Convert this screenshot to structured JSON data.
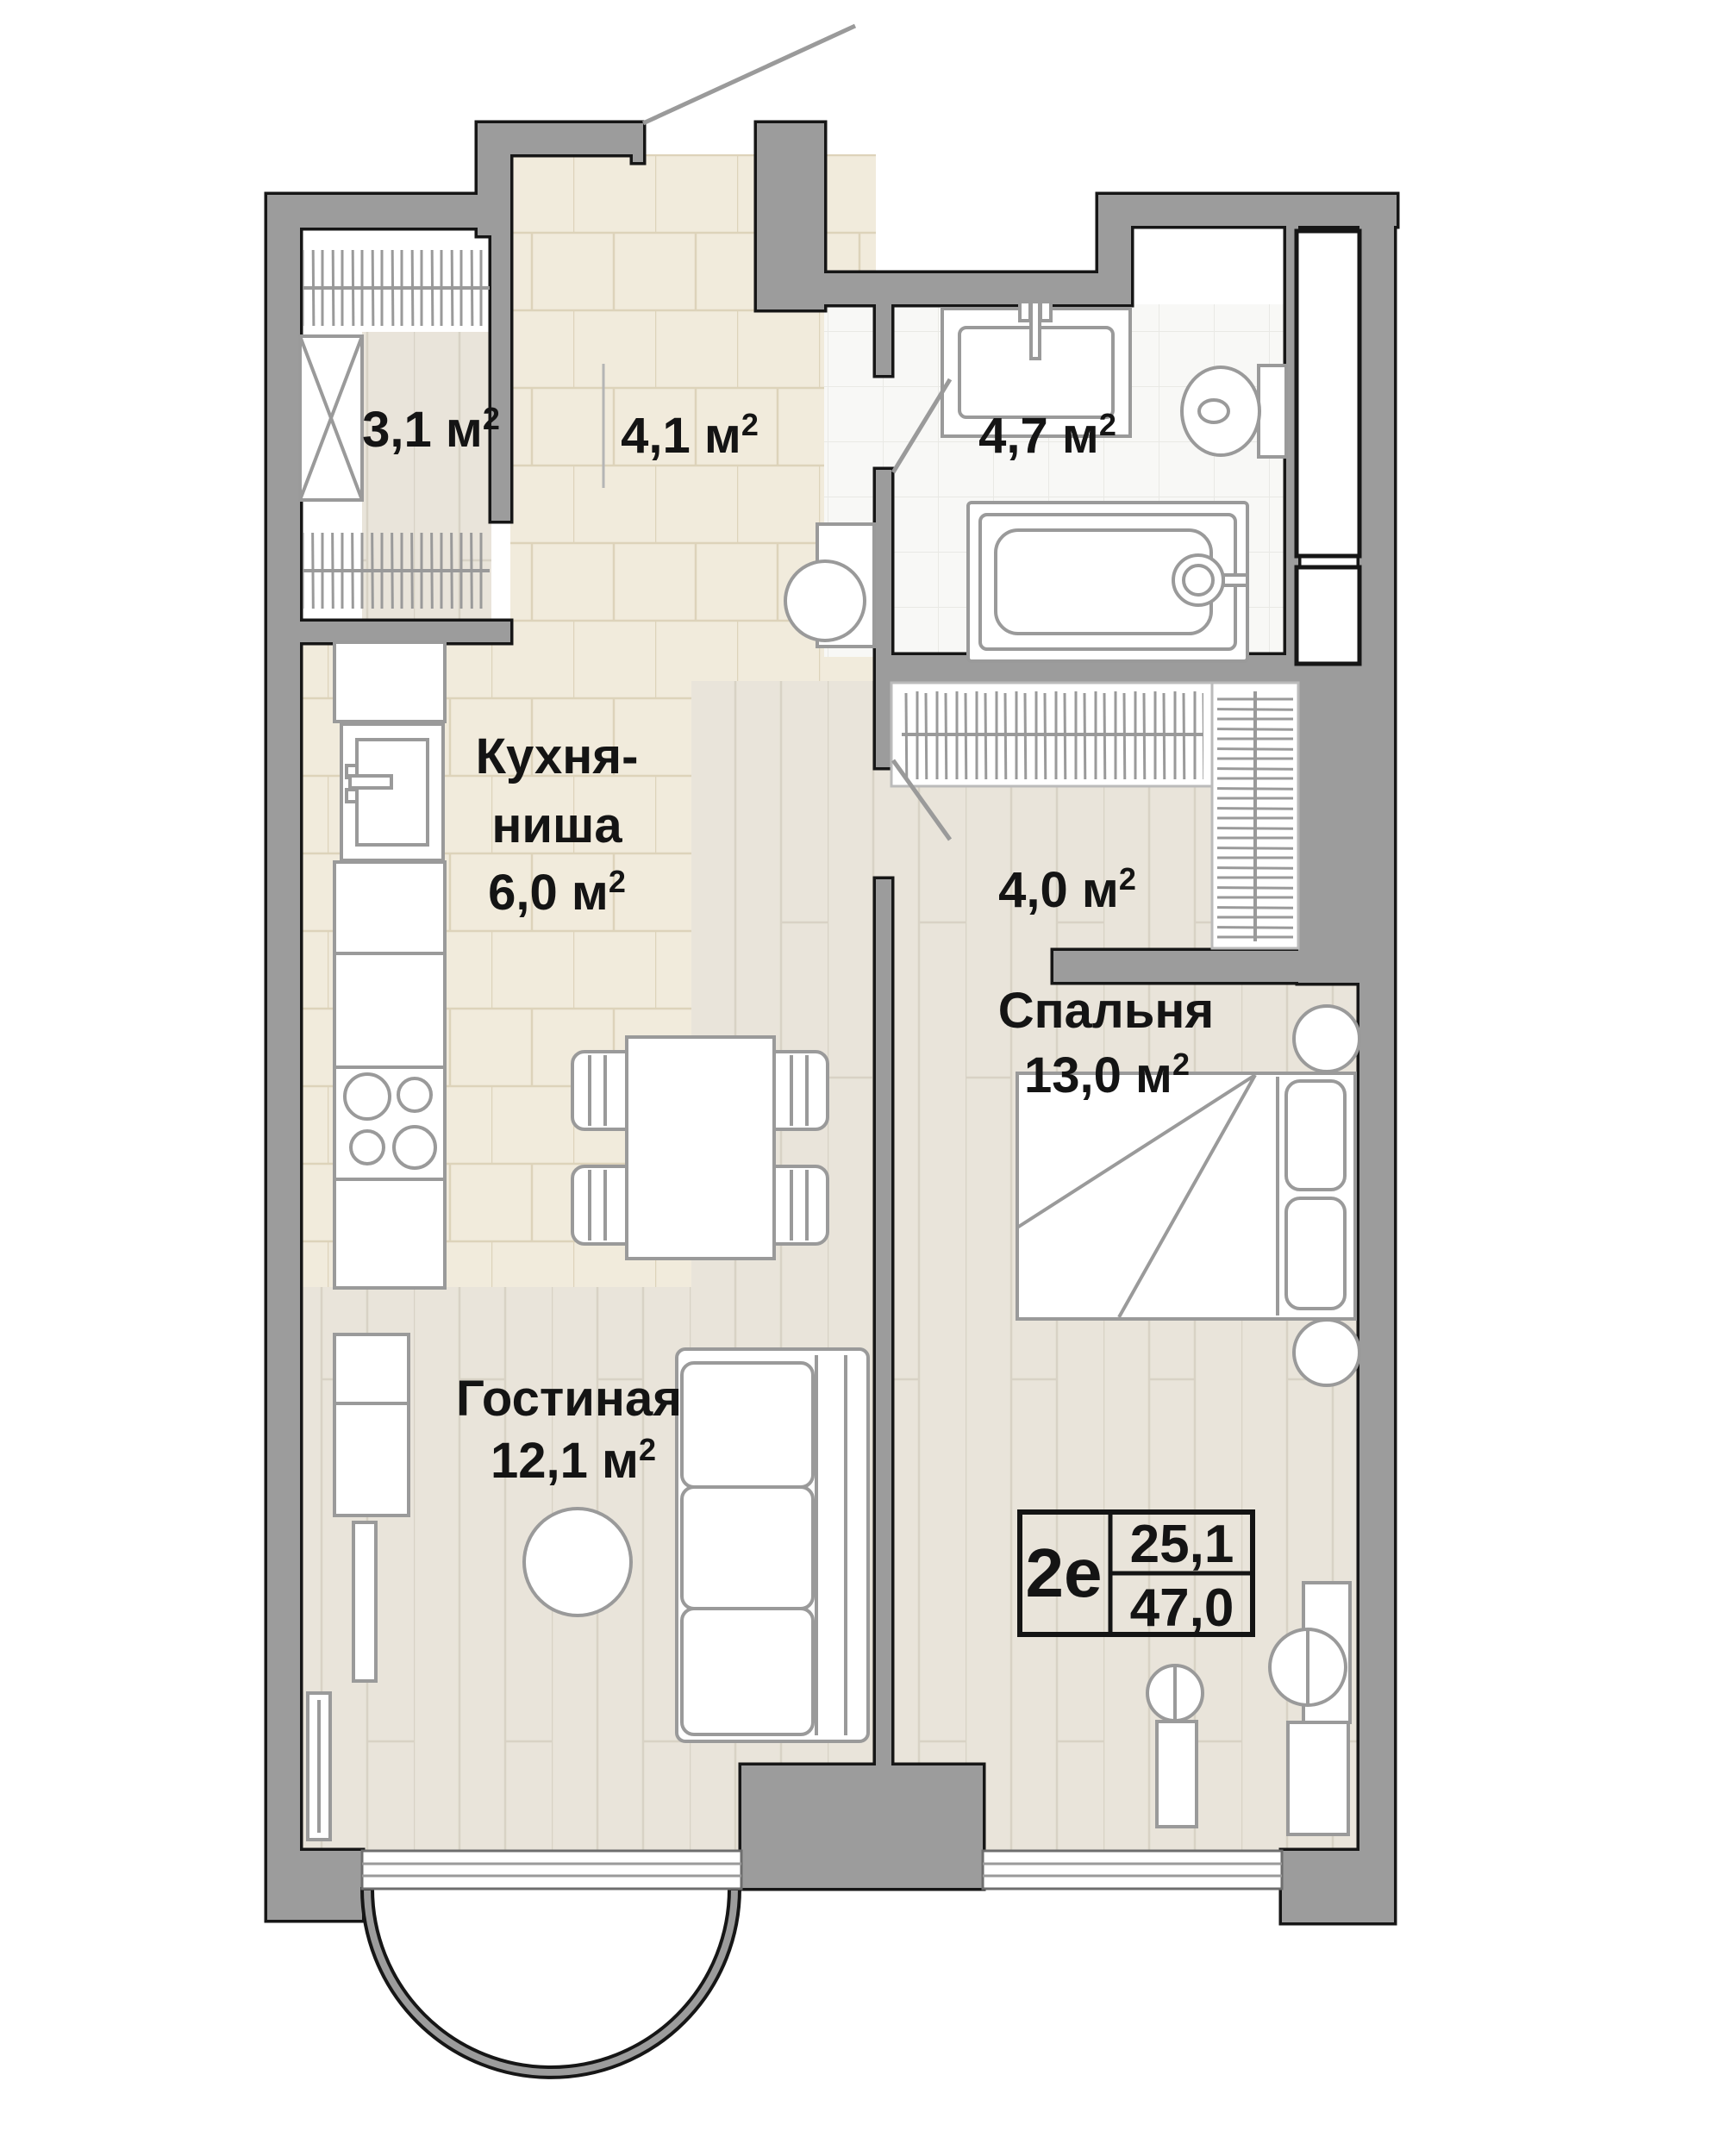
{
  "plan": {
    "rooms": {
      "wardrobe": {
        "area": "3,1 м",
        "sup": "2"
      },
      "hallway": {
        "area": "4,1 м",
        "sup": "2"
      },
      "bathroom": {
        "area": "4,7 м",
        "sup": "2"
      },
      "kitchen": {
        "name_line1": "Кухня-",
        "name_line2": "ниша",
        "area": "6,0 м",
        "sup": "2"
      },
      "corridor": {
        "area": "4,0 м",
        "sup": "2"
      },
      "bedroom": {
        "name": "Спальня",
        "area": "13,0 м",
        "sup": "2"
      },
      "living": {
        "name": "Гостиная",
        "area": "12,1 м",
        "sup": "2"
      }
    },
    "info_box": {
      "type": "2е",
      "area_living": "25,1",
      "area_total": "47,0"
    },
    "colors": {
      "wall": "#9c9c9c",
      "outline": "#161616",
      "furniture_stroke": "#9a9a9a",
      "text": "#141414",
      "tile_floor": "#f1ebdc",
      "wood_floor": "#e9e4da",
      "bath_floor": "#f8f8f6"
    }
  }
}
